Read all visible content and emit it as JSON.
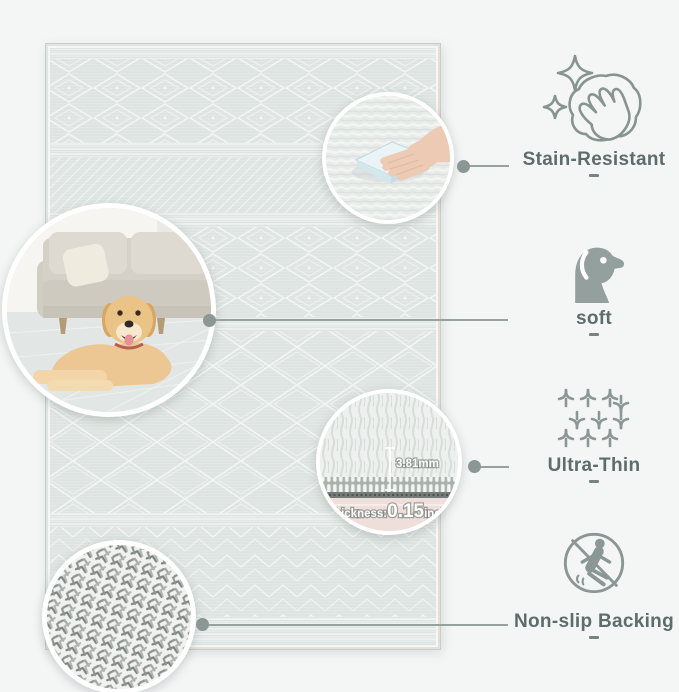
{
  "canvas": {
    "width": 679,
    "height": 692,
    "background": "#f4f6f6"
  },
  "rug": {
    "style": "boho geometric diamond bands",
    "base_color": "#dde4e1",
    "pattern_color": "#f3f6f4",
    "edge_color": "#ecd8d2"
  },
  "features": [
    {
      "label": "Stain-Resistant",
      "icon": "sparkle-clean-hand-icon"
    },
    {
      "label": "soft",
      "icon": "dog-icon"
    },
    {
      "label": "Ultra-Thin",
      "icon": "woven-fabric-icon"
    },
    {
      "label": "Non-slip Backing",
      "icon": "no-slipping-person-icon"
    }
  ],
  "insets": {
    "living_room": {
      "description": "golden retriever lying on rug in front of beige sofa"
    },
    "stain_demo": {
      "description": "hand wiping rug pile with light blue cloth"
    },
    "thickness": {
      "pile_height": "3.81mm",
      "label": "thickness:",
      "value": "0.15",
      "unit": "inch"
    },
    "backing": {
      "description": "woven non-slip backing texture close-up"
    }
  },
  "colors": {
    "icon": "#87948f",
    "label_text": "#5e6c6b",
    "connector": "#97a29f",
    "dot": "#8b9794"
  }
}
